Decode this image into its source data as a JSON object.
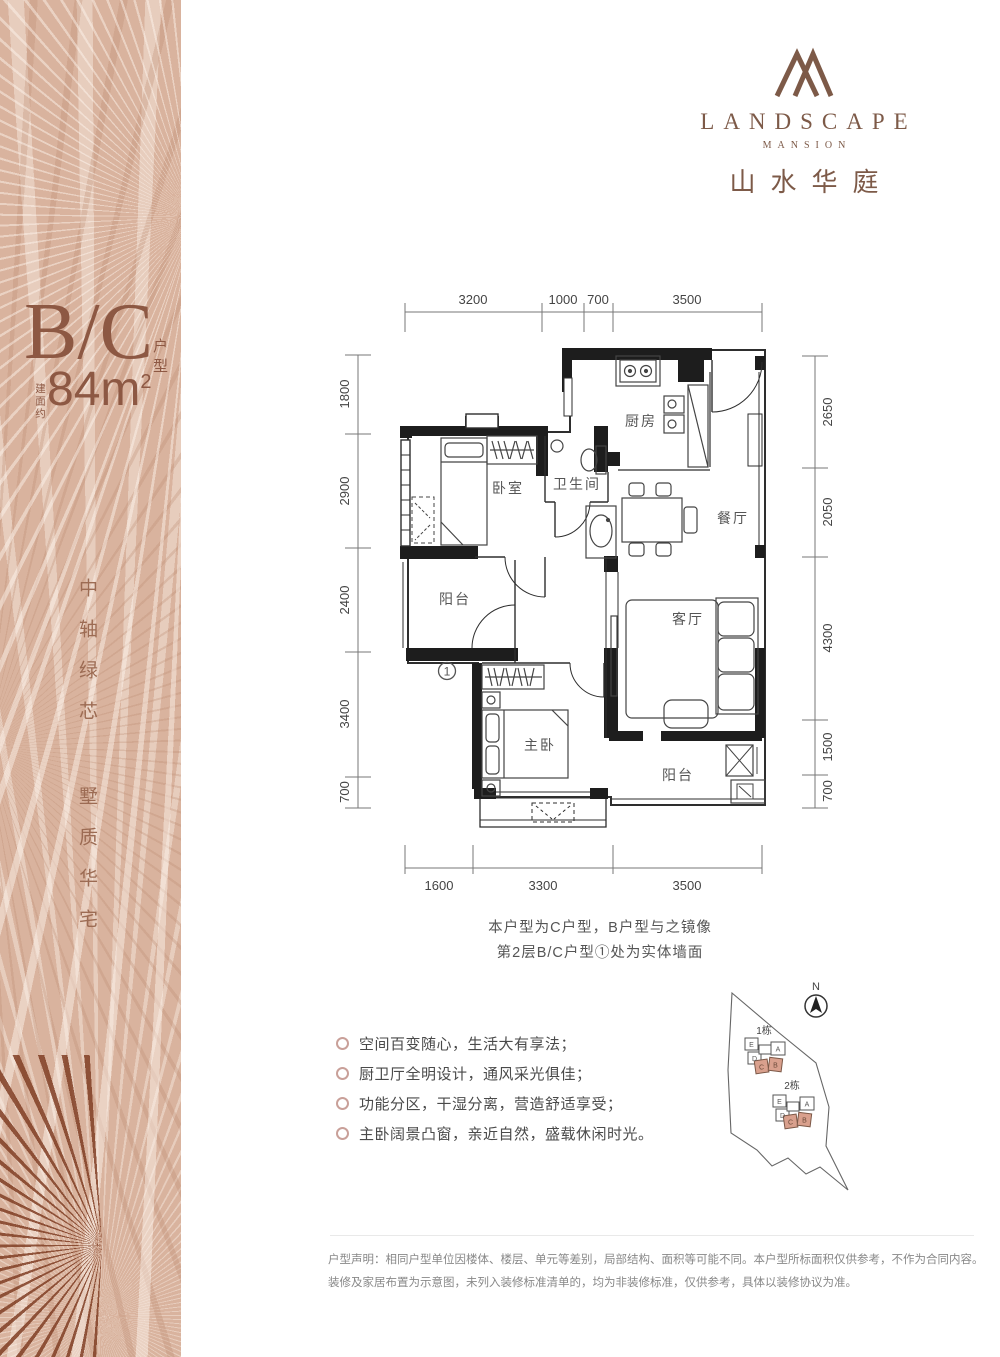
{
  "brand": {
    "logo_icon": "mountain-monogram-icon",
    "name_en": "LANDSCAPE",
    "name_sub": "MANSION",
    "name_cn": "山水华庭"
  },
  "sidebar": {
    "unit_code": "B/C",
    "unit_label": "户型",
    "area_prefix": "建面约",
    "area_main": "84m",
    "area_sup": "2",
    "slogan_1": "中轴绿芯",
    "slogan_2": "墅质华宅"
  },
  "floorplan": {
    "dims_top": [
      "3200",
      "1000",
      "700",
      "3500"
    ],
    "dims_left": [
      "1800",
      "2900",
      "2400",
      "3400",
      "700"
    ],
    "dims_right": [
      "2650",
      "2050",
      "4300",
      "1500",
      "700"
    ],
    "dims_bottom": [
      "1600",
      "3300",
      "3500"
    ],
    "rooms": {
      "kitchen": "厨房",
      "bedroom": "卧室",
      "bathroom": "卫生间",
      "dining": "餐厅",
      "balcony_top": "阳台",
      "living": "客厅",
      "master": "主卧",
      "balcony_bottom": "阳台"
    },
    "marker_1": "1",
    "notes": [
      "本户型为C户型，B户型与之镜像",
      "第2层B/C户型①处为实体墙面"
    ]
  },
  "features": [
    "空间百变随心，生活大有享法；",
    "厨卫厅全明设计，通风采光俱佳；",
    "功能分区，干湿分离，营造舒适享受；",
    "主卧阔景凸窗，亲近自然，盛载休闲时光。"
  ],
  "sitemap": {
    "north": "N",
    "cluster_1": "1栋",
    "cluster_2": "2栋",
    "units": [
      "E",
      "D",
      "A",
      "C",
      "B"
    ]
  },
  "disclaimer": [
    "户型声明：相同户型单位因楼体、楼层、单元等差别，局部结构、面积等可能不同。本户型所标面积仅供参考，不作为合同内容。",
    "装修及家居布置为示意图，未列入装修标准清单的，均为非装修标准，仅供参考，具体以装修协议为准。"
  ],
  "colors": {
    "accent_brown": "#7d5a48",
    "sidebar_tan": "#d9b39e",
    "text_brown": "#8d5843",
    "highlight_pink": "#d9a08d",
    "wall_black": "#1d1d1d"
  }
}
